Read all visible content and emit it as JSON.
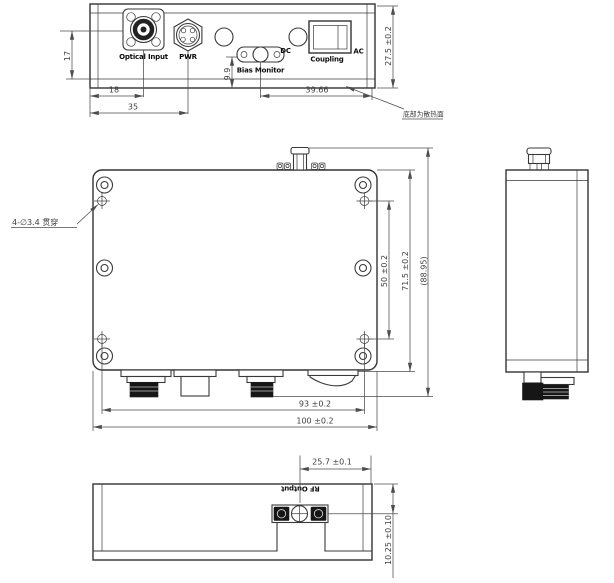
{
  "drawing": {
    "front_view": {
      "labels": {
        "optical_input": "Optical Input",
        "pwr": "PWR",
        "bias_monitor": "Bias Monitor",
        "dc": "DC",
        "coupling": "Coupling",
        "ac": "AC"
      },
      "dimensions": {
        "height_17": "17",
        "width_18": "18",
        "width_35": "35",
        "height_9_9": "9.9",
        "width_39_66": "39.66",
        "height_27_5": "27.5 ±0.2"
      },
      "note_heatsink": "底部为散热面"
    },
    "top_view": {
      "note_mounting_holes": "4-∅3.4 贯穿",
      "dimensions": {
        "hole_spacing_50": "50 ±0.2",
        "height_71_5": "71.5 ±0.2",
        "overall_88_95": "(88.95)",
        "hole_spacing_93": "93 ±0.2",
        "width_100": "100 ±0.2"
      }
    },
    "bottom_view": {
      "labels": {
        "rf_output": "RF Output"
      },
      "dimensions": {
        "offset_25_7": "25.7 ±0.1",
        "depth_10_25": "10.25 ±0.10"
      }
    },
    "line_color": "#3a3a3a",
    "background": "#ffffff"
  }
}
